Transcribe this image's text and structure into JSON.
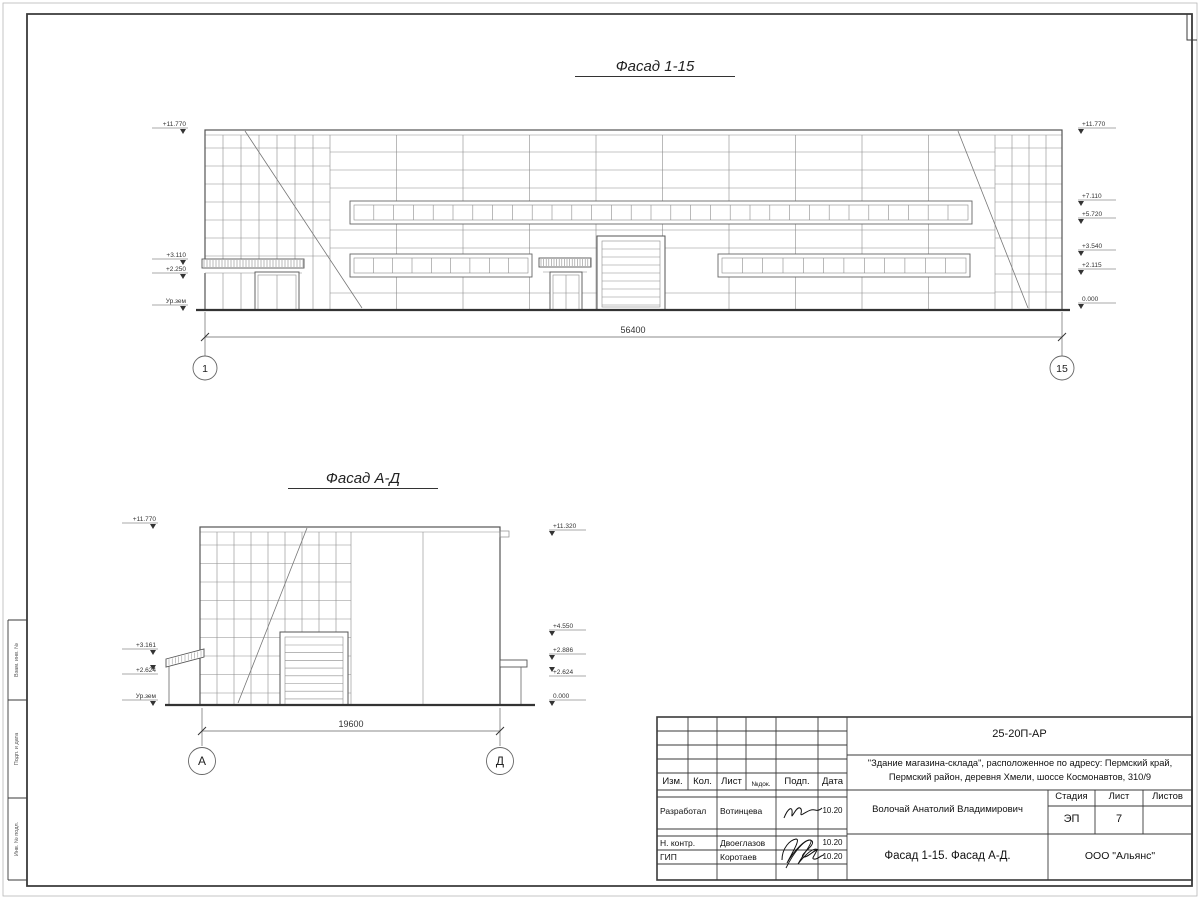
{
  "sheet": {
    "margin_labels": [
      "Взам. инв. №",
      "Подп. и дата",
      "Инв. № подл."
    ]
  },
  "facade1": {
    "title": "Фасад 1-15",
    "dim": "56400",
    "axis_start": "1",
    "axis_end": "15",
    "levels_left": [
      "+11.770",
      "+3.110",
      "+2.250",
      "Ур.зем"
    ],
    "levels_right": [
      "+11.770",
      "+7.110",
      "+5.720",
      "+3.540",
      "+2.115",
      "0.000"
    ]
  },
  "facade2": {
    "title": "Фасад А-Д",
    "dim": "19600",
    "axis_start": "А",
    "axis_end": "Д",
    "levels_left": [
      "+11.770",
      "+3.161",
      "+2.624",
      "Ур.зем"
    ],
    "levels_right": [
      "+11.320",
      "+4.550",
      "+2.886",
      "+2.624",
      "0.000"
    ]
  },
  "titleblock": {
    "doc_code": "25-20П-АР",
    "project_line1": "\"Здание магазина-склада\", расположенное по адресу: Пермский край,",
    "project_line2": "Пермский район, деревня Хмели, шоссе Космонавтов, 310/9",
    "header": {
      "izm": "Изм.",
      "kol": "Кол.",
      "list": "Лист",
      "ndok": "№док.",
      "podp": "Подп.",
      "data": "Дата"
    },
    "rows": [
      {
        "role": "Разработал",
        "name": "Вотинцева",
        "date": "10.20"
      },
      {
        "role": "Н. контр.",
        "name": "Двоеглазов",
        "date": "10.20"
      },
      {
        "role": "ГИП",
        "name": "Коротаев",
        "date": "10.20"
      }
    ],
    "author_full": "Волочай Анатолий Владимирович",
    "stage_label": "Стадия",
    "sheet_label": "Лист",
    "sheets_label": "Листов",
    "stage": "ЭП",
    "sheet_no": "7",
    "sheets_total": "",
    "drawing_title": "Фасад 1-15. Фасад А-Д.",
    "company": "ООО \"Альянс\""
  }
}
